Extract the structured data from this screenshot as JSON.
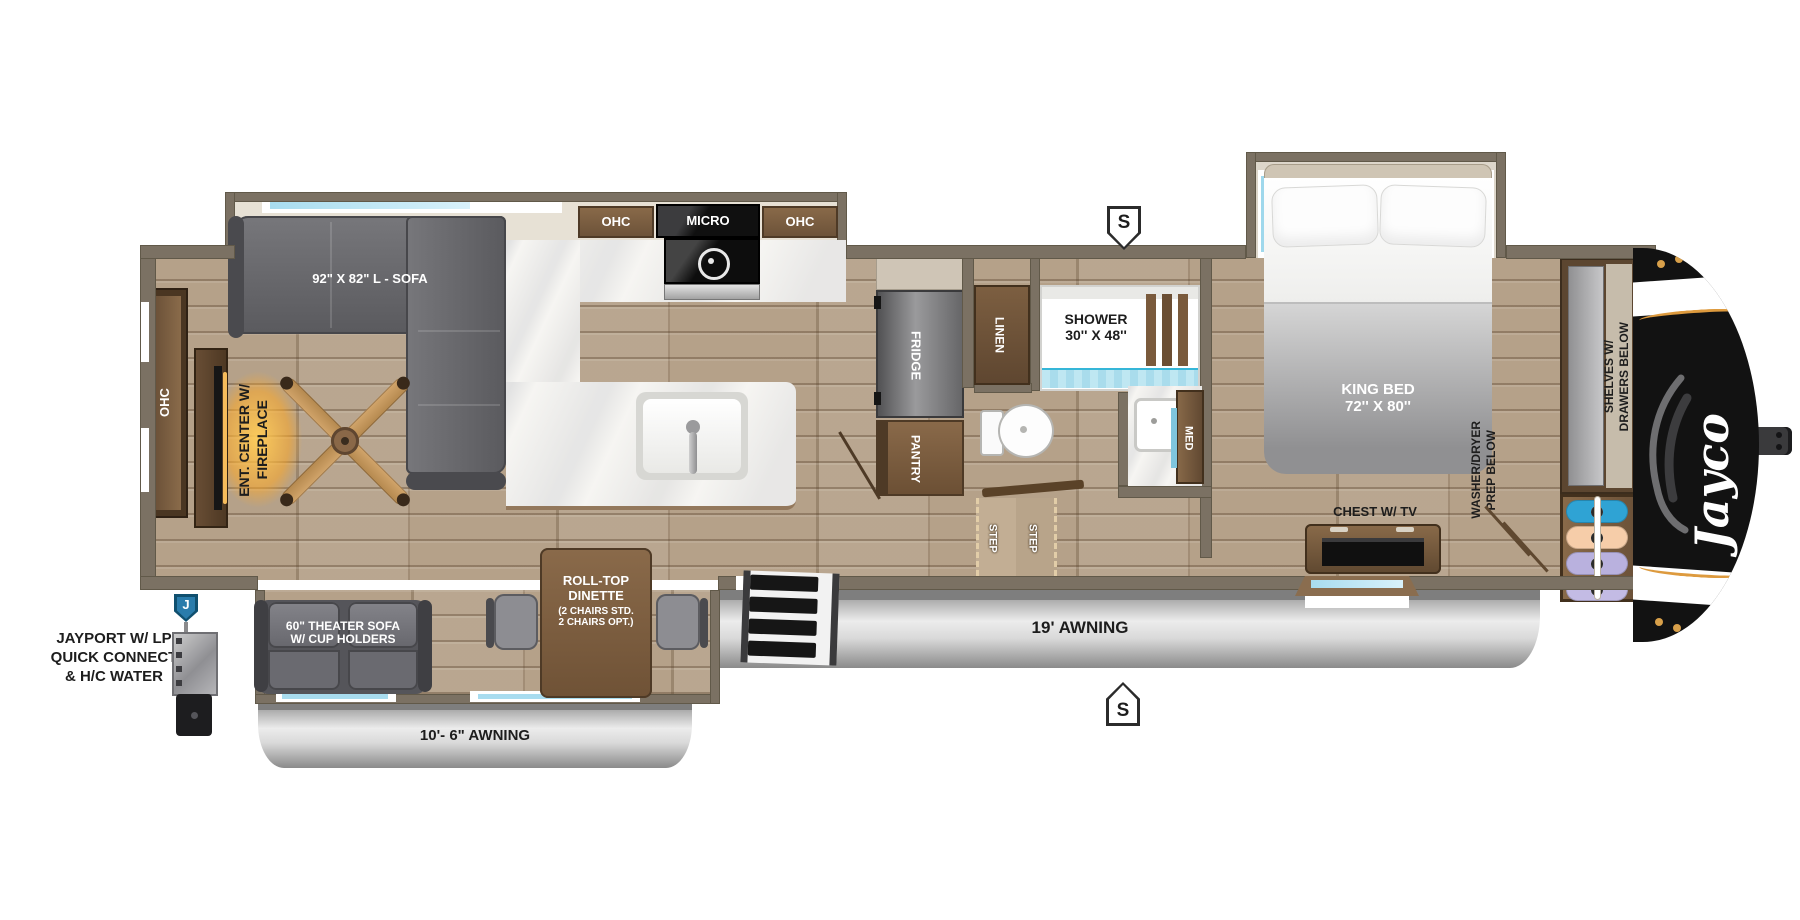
{
  "title": "Jayco fifth wheel RV floor plan",
  "brand": {
    "logo": "Jayco"
  },
  "markers": {
    "s_top": "S",
    "s_bottom": "S",
    "jayport_tag": "J"
  },
  "jayport": {
    "l1": "JAYPORT W/ LP",
    "l2": "QUICK CONNECT",
    "l3": "& H/C WATER"
  },
  "labels": {
    "sofa": "92\" X 82\" L - SOFA",
    "ohc_rear": "OHC",
    "ohc_left": "OHC",
    "ohc_right": "OHC",
    "micro": "MICRO",
    "fridge": "FRIDGE",
    "pantry": "PANTRY",
    "linen": "LINEN",
    "shower_l1": "SHOWER",
    "shower_l2": "30'' X 48''",
    "med": "MED",
    "step1": "STEP",
    "step2": "STEP",
    "king_l1": "KING BED",
    "king_l2": "72'' X 80''",
    "chest": "CHEST W/ TV",
    "washer_l1": "WASHER/DRYER",
    "washer_l2": "PREP BELOW",
    "shelves_l1": "SHELVES W/",
    "shelves_l2": "DRAWERS BELOW",
    "ent_l1": "ENT. CENTER W/",
    "ent_l2": "FIREPLACE",
    "theater_l1": "60\" THEATER SOFA",
    "theater_l2": "W/ CUP HOLDERS",
    "dinette_l1": "ROLL-TOP",
    "dinette_l2": "DINETTE",
    "dinette_l3": "(2 CHAIRS STD.",
    "dinette_l4": "2 CHAIRS OPT.)",
    "awning_main": "19' AWNING",
    "awning_rear": "10'- 6\" AWNING"
  },
  "colors": {
    "wall": "#7b7163",
    "floor_wood": "#b5a189",
    "cabinet_brown": "#7a5f43",
    "sofa_gray": "#606064",
    "counter_white": "#f6f5f2",
    "water_blue": "#bfe7f2",
    "window_blue": "#a8dcef",
    "awning_silver": "#cccccc",
    "front_cap_black": "#141414",
    "cap_accent_orange": "#dd9a3e",
    "marker_blue": "#2a7cab"
  }
}
